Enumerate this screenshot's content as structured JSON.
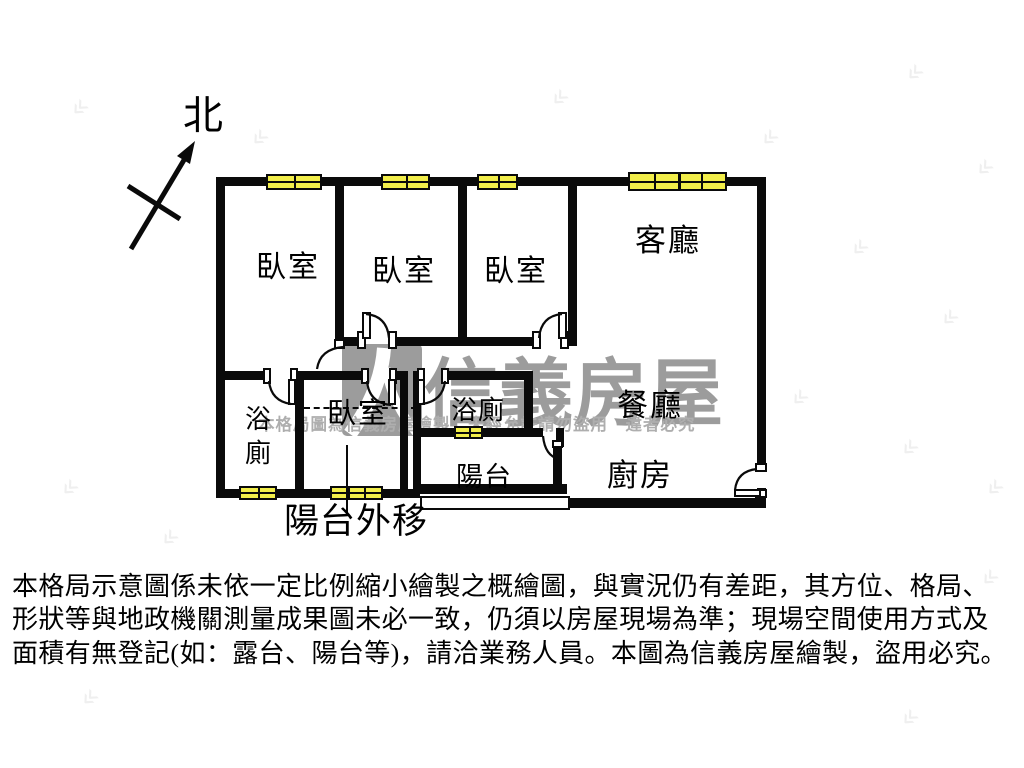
{
  "north_label": "北",
  "rooms": {
    "bedroom1": "臥室",
    "bedroom2": "臥室",
    "bedroom3": "臥室",
    "bedroom4": "臥室",
    "living_room": "客廳",
    "dining_room": "餐廳",
    "kitchen": "廚房",
    "bathroom1": "浴廁",
    "bathroom2": "浴廁",
    "balcony": "陽台",
    "balcony_note": "陽台外移"
  },
  "watermark": {
    "brand": "信義房屋",
    "notice": "本格局圖為信義房屋繪製　未經允許請勿盜用　違者必究"
  },
  "disclaimer": {
    "line1": "本格局示意圖係未依一定比例縮小繪製之概繪圖，與實況仍有差距，其方位、格局、",
    "line2": "形狀等與地政機關測量成果圖未必一致，仍須以房屋現場為準；現場空間使用方式及",
    "line3": "面積有無登記(如：露台、陽台等)，請洽業務人員。本圖為信義房屋繪製，盜用必究。"
  },
  "colors": {
    "wall": "#0a0a0a",
    "window_fill": "#f2ee4a",
    "watermark_gray": "#9c9c9c"
  }
}
